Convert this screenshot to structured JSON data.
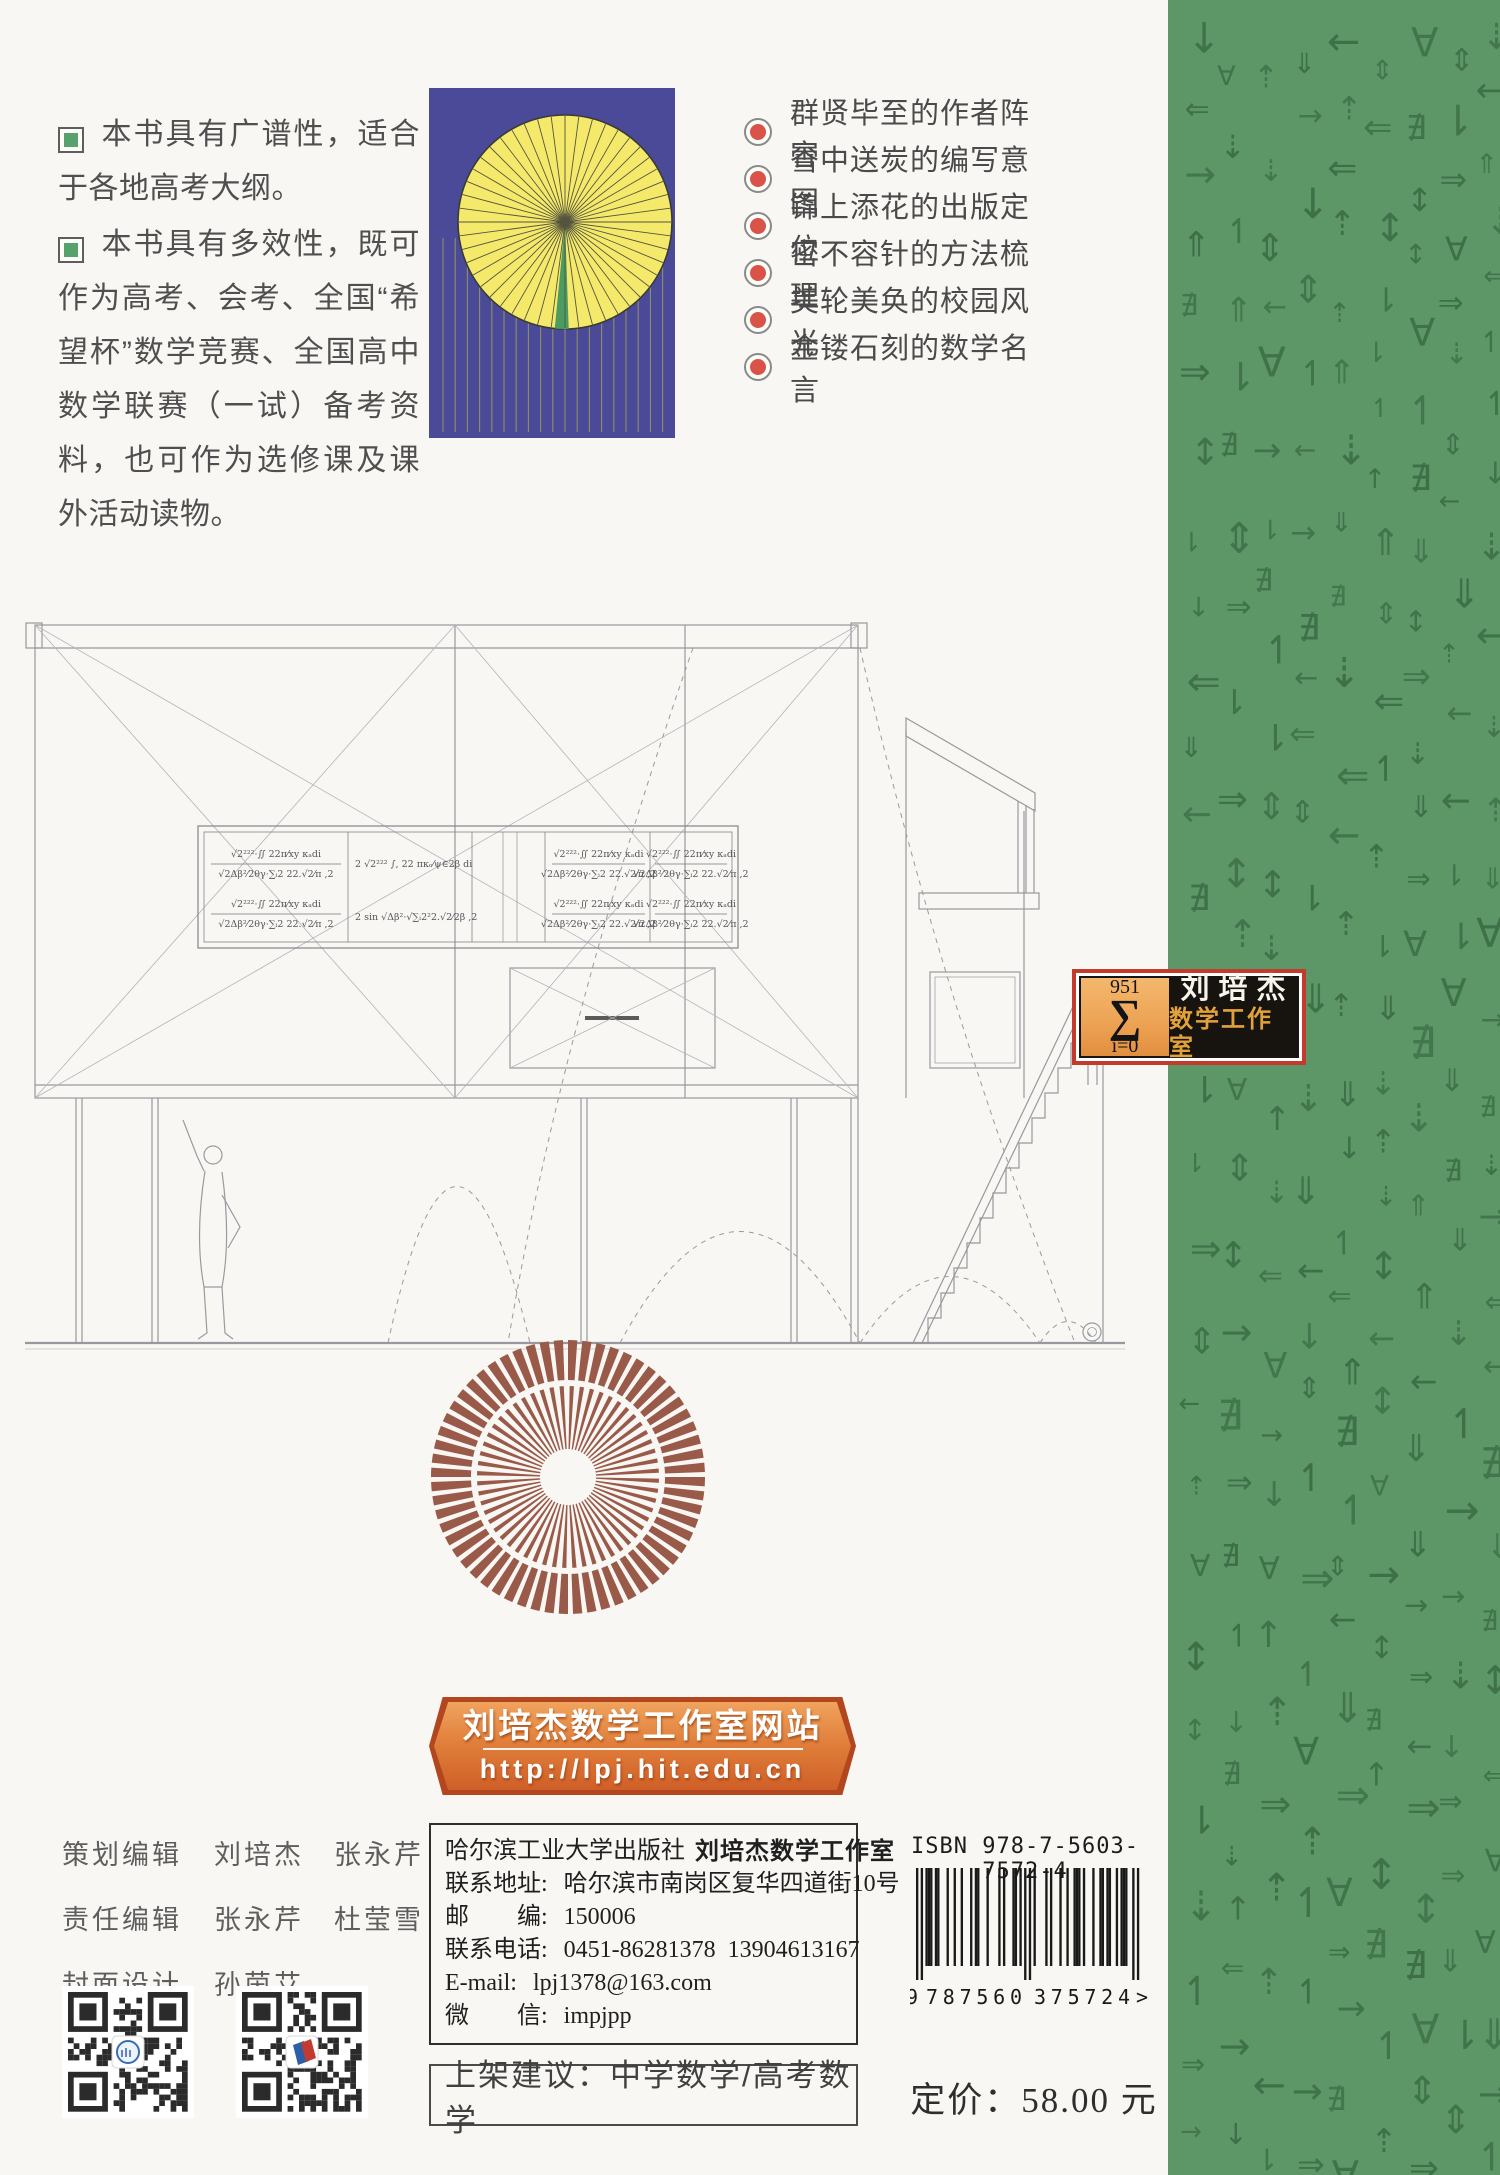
{
  "page": {
    "bg": "#f8f7f3"
  },
  "intro": {
    "bullet_color": "#56a26c",
    "bullets": [
      {
        "icon": "green-square",
        "text": "本书具有广谱性，适合于各地高考大纲。"
      },
      {
        "icon": "green-square",
        "text": "本书具有多效性，既可作为高考、会考、全国“希望杯”数学竞赛、全国高中数学联赛（一试）备考资料，也可作为选修课及课外活动读物。"
      }
    ]
  },
  "cover_art": {
    "bg": "#4a4a98",
    "disc_color": "#f5e96b",
    "disc_edge": "#3a3a35",
    "ray_color": "#55553f",
    "wedge_color": "#4c9c62",
    "hang_line_color": "#8f8f63"
  },
  "features": {
    "bullet_color": "#da5348",
    "items": [
      "群贤毕至的作者阵容",
      "雪中送炭的编写意图",
      "锦上添花的出版定位",
      "密不容针的方法梳理",
      "美轮美奂的校园风光",
      "金镂石刻的数学名言"
    ]
  },
  "drawing": {
    "stroke": "#98989e",
    "formulas": {
      "frac_top": "√2²²²·∬ 22π⁄xy κₐdi",
      "frac_bottom": "√2Δβ²⁄2θγ·∑ᵢ2 22.√2⁄π ,2",
      "inline1": "2 √2²²² ∫, 22 πκₒ⁄ψ∈2β di",
      "inline2": "2 sin √Δβ²·√∑ᵢ2²2.√2⁄2β ,2"
    }
  },
  "studio_badge": {
    "sum_upper": "951",
    "sum_symbol": "∑",
    "sum_lower": "i=0",
    "name_line1": "刘培杰",
    "name_line2": "数学工作室",
    "frame_color": "#c43a2c",
    "left_bg": "#eda253",
    "gold": "#e2a23b"
  },
  "brown_fan": {
    "color": "#9a5a49"
  },
  "website_banner": {
    "title": "刘培杰数学工作室网站",
    "url": "http://lpj.hit.edu.cn",
    "bg_dark": "#b2471f"
  },
  "credits": {
    "rows": [
      {
        "role": "策划编辑",
        "names": [
          "刘培杰",
          "张永芹"
        ]
      },
      {
        "role": "责任编辑",
        "names": [
          "张永芹",
          "杜莹雪"
        ]
      },
      {
        "role": "封面设计",
        "names": [
          "孙茵艾"
        ]
      }
    ]
  },
  "qr": {
    "logo1_color": "#3a6cb3",
    "logo2_blue": "#2d5ea6",
    "logo2_red": "#c23b31"
  },
  "publisher": {
    "line1_normal": "哈尔滨工业大学出版社",
    "line1_bold": "刘培杰数学工作室",
    "rows": [
      {
        "label": "联系地址: ",
        "value": "哈尔滨市南岗区复华四道街10号"
      },
      {
        "label": "邮　　编: ",
        "value": "150006"
      },
      {
        "label": "联系电话: ",
        "value": "0451-86281378  13904613167"
      },
      {
        "label": "E-mail: ",
        "value": "lpj1378@163.com"
      },
      {
        "label": "微　　信: ",
        "value": "impjpp"
      }
    ]
  },
  "shelving": {
    "text": "上架建议：中学数学/高考数学"
  },
  "isbn": {
    "label": "ISBN 978-7-5603-7572-4",
    "code": "9787560375724",
    "d1": "9",
    "d2": "787560",
    "d3": "375724",
    "suffix": ">"
  },
  "price": {
    "text": "定价：58.00 元"
  },
  "green_strip": {
    "bg": "#5d9768",
    "glyph_color": "#3e7048",
    "glyphs": [
      "↓",
      "↑",
      "→",
      "←",
      "⇑",
      "⇓",
      "⇕",
      "⇐",
      "⇒",
      "↕",
      "⇡",
      "⇣",
      "↿",
      "⇂",
      "∄",
      "∀"
    ]
  }
}
